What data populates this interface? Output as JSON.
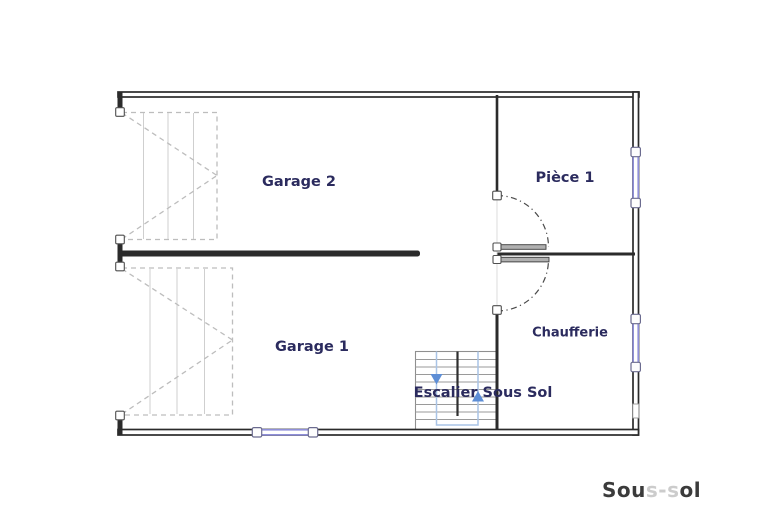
{
  "rooms": {
    "garage2": "Garage 2",
    "piece1": "Pièce 1",
    "garage1": "Garage 1",
    "chaufferie": "Chaufferie",
    "stairs": "Escalier Sous Sol"
  },
  "floor_label": {
    "prefix": "Sou",
    "faded": "s-s",
    "suffix": "ol"
  },
  "colors": {
    "wall": "#2b2b2b",
    "room_label": "#2b2b5e",
    "window_blue": "#8f8fd9",
    "stair_gray": "#9a9a9a",
    "walkline_blue": "#a9c4e6",
    "arrow_blue": "#5d8ed6",
    "door_dash_gray": "#bdbdbd",
    "title_dark": "#3b3b3b",
    "title_faded": "#cccccc"
  }
}
